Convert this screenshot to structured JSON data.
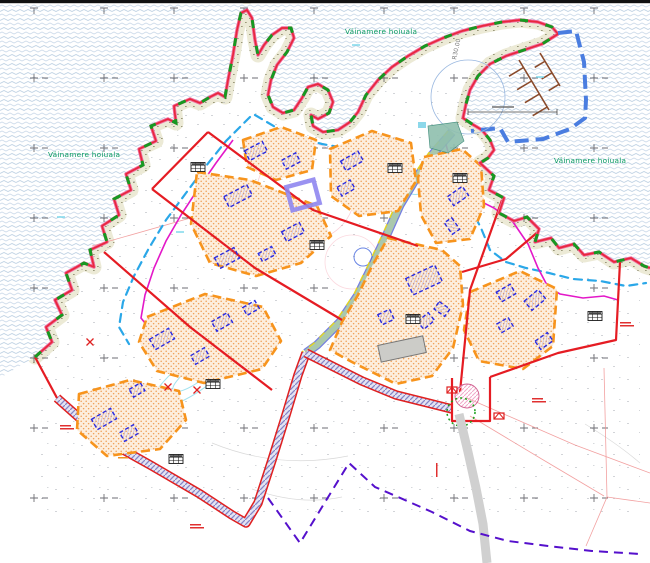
{
  "map": {
    "labels": {
      "protected_area_left": "Väinamere hoiuala",
      "protected_area_top": "Väinamere hoiuala",
      "protected_area_right": "Väinamere hoiuala",
      "radius_annotation": "R30.00"
    },
    "colors": {
      "sea_wave": "#bfd2e4",
      "shore_fill": "#ecead6",
      "coast_red": "#e8283c",
      "coast_halo_magenta": "#ef6aa0",
      "protected_boundary_green": "#169a21",
      "protected_label_green": "#089a60",
      "plot_boundary_red": "#e51c23",
      "zone_border_orange": "#f7941d",
      "zone_fill": "#fdeedd",
      "planned_building_blue": "#2a2ae0",
      "existing_plot_purple": "#8f86f0",
      "road_teal": "#aac8ad",
      "road_hatch_purple": "#8585c8",
      "harbor_boundary_blue": "#4a7de0",
      "pier_brown": "#8a4a2a",
      "stream_blue": "#2aa7e8",
      "utility_magenta": "#e318c8",
      "cadastral_pink": "#f09090",
      "road_gray": "#d0d0d0",
      "boundary_purple_dash": "#5510cc",
      "yellow_edge": "#e6d61a"
    }
  }
}
